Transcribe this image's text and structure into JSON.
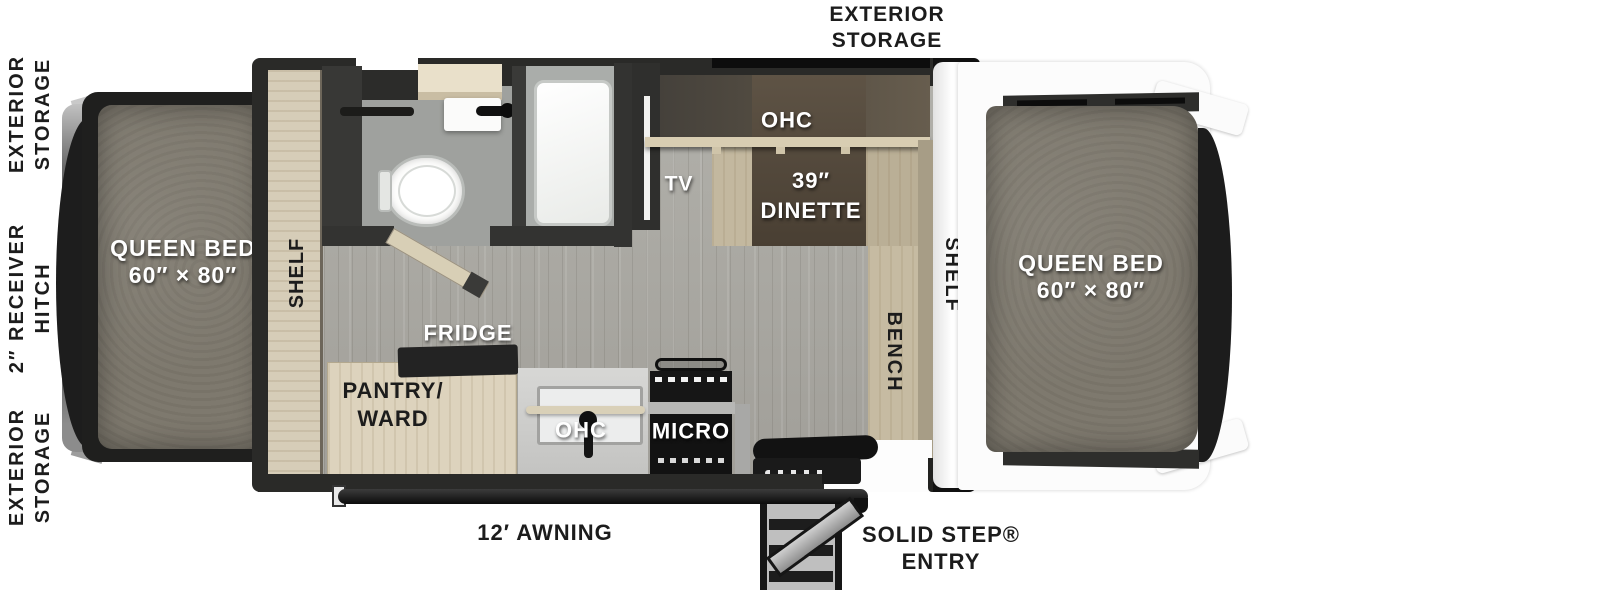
{
  "exterior": {
    "left_top": {
      "line1": "EXTERIOR",
      "line2": "STORAGE"
    },
    "left_middle": {
      "line1": "2″ RECEIVER",
      "line2": "HITCH"
    },
    "left_bottom": {
      "line1": "EXTERIOR",
      "line2": "STORAGE"
    },
    "top": {
      "line1": "EXTERIOR",
      "line2": "STORAGE"
    },
    "awning_label": "12′ AWNING",
    "entry": {
      "line1": "SOLID STEP®",
      "line2": "ENTRY"
    }
  },
  "beds": {
    "left": {
      "name": "QUEEN BED",
      "size": "60″ × 80″"
    },
    "right": {
      "name": "QUEEN BED",
      "size": "60″ × 80″"
    }
  },
  "interior": {
    "shelf_left": "SHELF",
    "shelf_right": "SHELF",
    "bench": "BENCH",
    "tv": "TV",
    "ohc_dinette": "OHC",
    "dinette": {
      "line1": "39″",
      "line2": "DINETTE"
    },
    "fridge": "FRIDGE",
    "pantry": {
      "line1": "PANTRY/",
      "line2": "WARD"
    },
    "ohc_kitchen": "OHC",
    "micro": "MICRO"
  },
  "colors": {
    "background": "#ffffff",
    "wall": "#2a2a28",
    "floor": "#a8a7a2",
    "cabinet_wood": "#d6cdb8",
    "mattress": "#7e796e",
    "table": "#53483c",
    "fixture_white": "#f4f5f3",
    "label_dark": "#1c1c1c",
    "label_light": "#ffffff"
  }
}
